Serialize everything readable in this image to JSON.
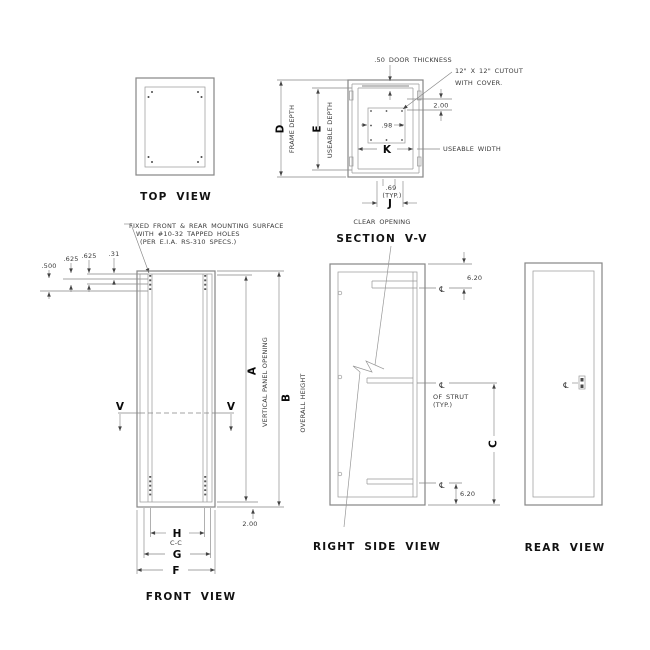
{
  "views": {
    "top": {
      "label": "TOP VIEW"
    },
    "section": {
      "label": "SECTION V-V",
      "sub": "CLEAR OPENING",
      "door": ".50 DOOR THICKNESS",
      "cutout1": "12\" X 12\" CUTOUT",
      "cutout2": "WITH COVER.",
      "d200": "2.00",
      "d98": ".98",
      "K": "K",
      "useable_width": "USEABLE WIDTH",
      "d69": ".69",
      "typ": "(TYP.)",
      "J": "J",
      "D": "D",
      "frame_depth": "FRAME DEPTH",
      "E": "E",
      "useable_depth": "USEABLE DEPTH"
    },
    "front": {
      "label": "FRONT VIEW",
      "note1": "FIXED FRONT & REAR MOUNTING SURFACE",
      "note2": "WITH #10-32 TAPPED HOLES",
      "note3": "(PER E.I.A. RS-310 SPECS.)",
      "d500": ".500",
      "d625a": ".625",
      "d625b": ".625",
      "d31": ".31",
      "V": "V",
      "A": "A",
      "vertical_panel_opening": "VERTICAL PANEL OPENING",
      "B": "B",
      "overall_height": "OVERALL HEIGHT",
      "d200": "2.00",
      "H": "H",
      "cc": "C-C",
      "G": "G",
      "F": "F"
    },
    "side": {
      "label": "RIGHT SIDE VIEW",
      "d620_top": "6.20",
      "d620_bot": "6.20",
      "cl": "℄",
      "of_strut1": "OF STRUT",
      "of_strut2": "(TYP.)",
      "C": "C"
    },
    "rear": {
      "label": "REAR VIEW",
      "cl": "℄"
    }
  }
}
